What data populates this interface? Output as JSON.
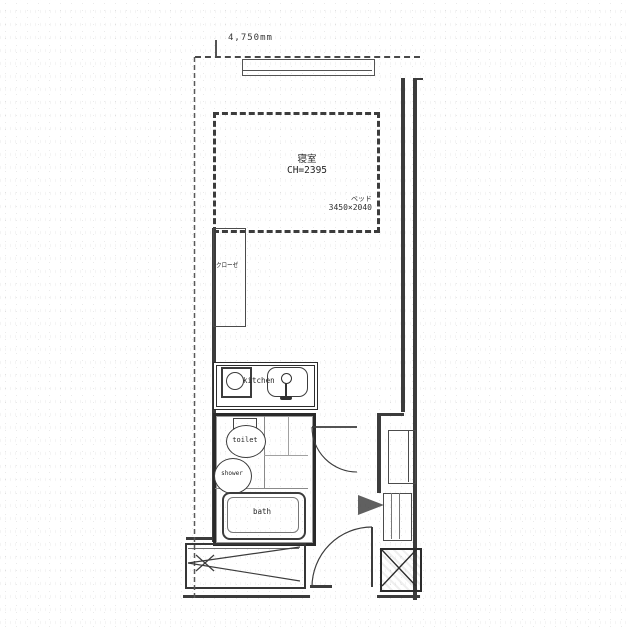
{
  "plan": {
    "type": "apartment-floor-plan",
    "dimension_top": "4,750mm",
    "bedroom": {
      "name": "寝室",
      "ceiling_height": "CH=2395"
    },
    "bed_note": {
      "label": "ベッド",
      "size": "3450×2040"
    },
    "closet_label": "クローゼ",
    "kitchen_label": "kitchen",
    "toilet_label": "toilet",
    "shower_label": "shower",
    "bath_label": "bath",
    "colors": {
      "ink": "#3d3d3d",
      "paper": "#ffffff"
    }
  }
}
